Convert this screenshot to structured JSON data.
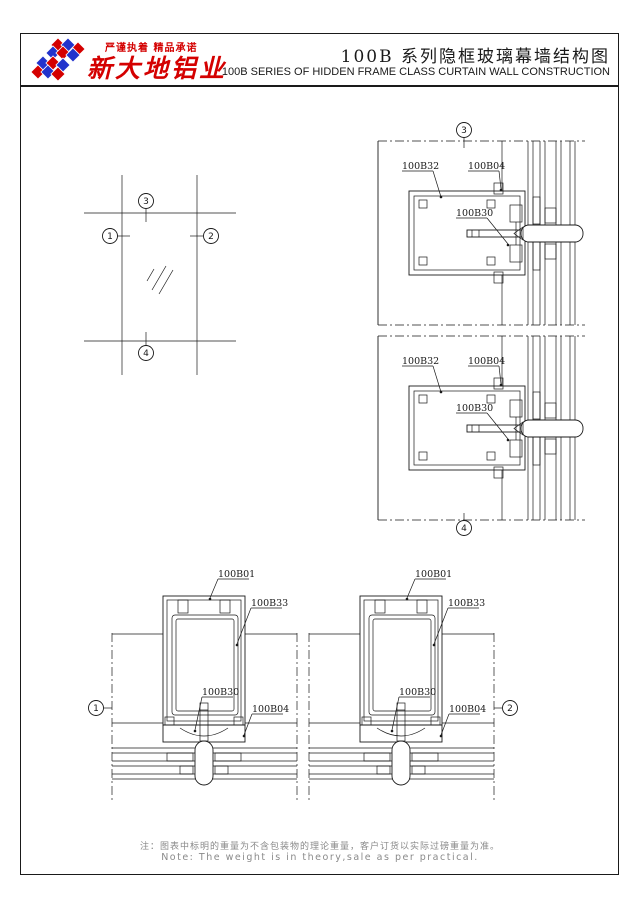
{
  "header": {
    "slogan": "严谨执着 精品承诺",
    "company": "新大地铝业",
    "title_cn": "100B 系列隐框玻璃幕墙结构图",
    "title_en": "100B   SERIES OF HIDDEN FRAME CLASS CURTAIN WALL CONSTRUCTION",
    "brand_red": "#d40000",
    "brand_blue": "#2233cc"
  },
  "elevation": {
    "callout_left": "1",
    "callout_right": "2",
    "callout_top": "3",
    "callout_bottom": "4"
  },
  "details": {
    "top_section": {
      "callout": "3",
      "part_frame": "100B32",
      "part_gasket": "100B04",
      "part_connector": "100B30"
    },
    "bottom_section": {
      "callout": "4",
      "part_frame": "100B32",
      "part_gasket": "100B04",
      "part_connector": "100B30"
    },
    "left_mullion": {
      "callout": "1",
      "part_box": "100B01",
      "part_insert": "100B33",
      "part_connector": "100B30",
      "part_adapter": "100B04"
    },
    "right_mullion": {
      "callout": "2",
      "part_box": "100B01",
      "part_insert": "100B33",
      "part_connector": "100B30",
      "part_adapter": "100B04"
    }
  },
  "footer": {
    "note_cn": "注：图表中标明的重量为不含包装物的理论重量，客户订货以实际过磅重量为准。",
    "note_en": "Note: The weight is in theory,sale as per practical."
  }
}
